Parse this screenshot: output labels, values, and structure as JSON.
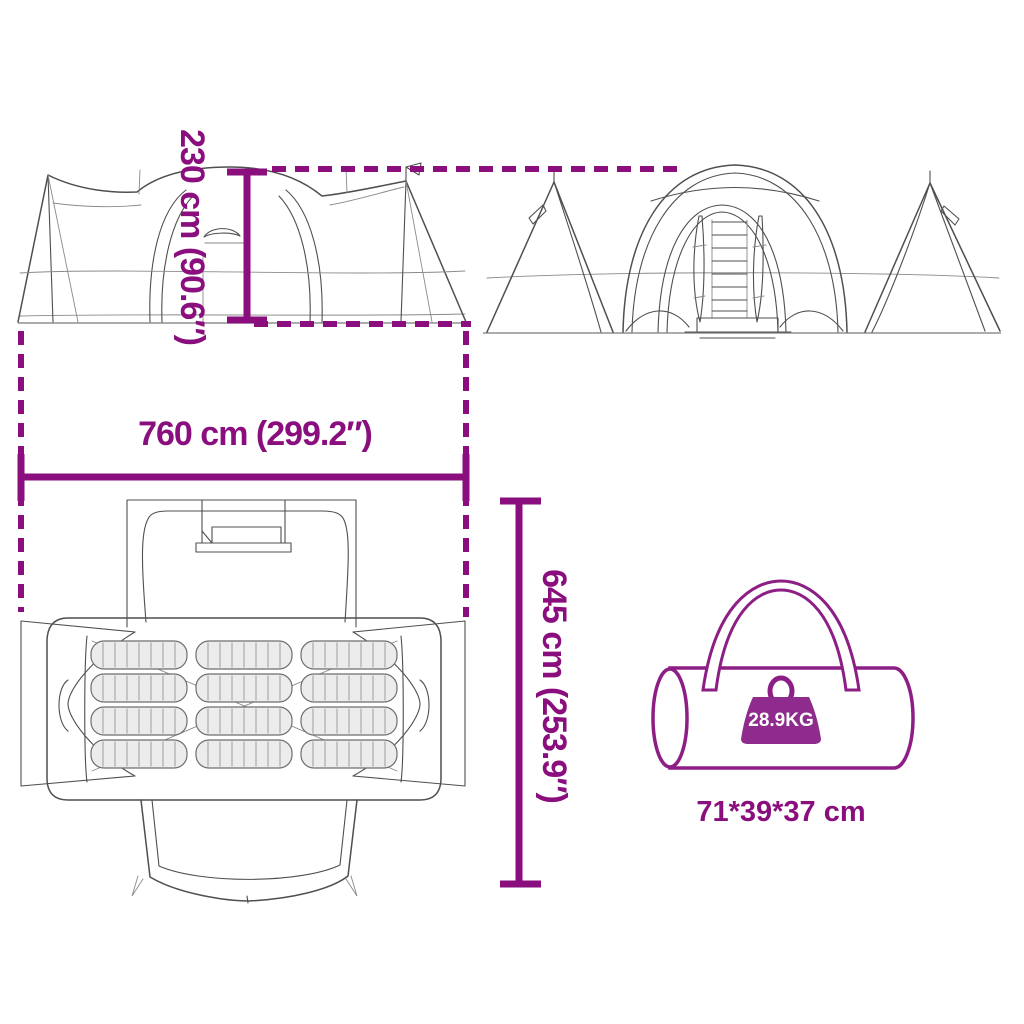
{
  "title": "Tent dimensions product diagram",
  "colors": {
    "accent": "#8A0E7D",
    "badge": "#8E2B8C",
    "bag_outline": "#8C1E85",
    "line_art": "#4F4F4F",
    "mat_fill": "#ECECEC",
    "background": "#FFFFFF"
  },
  "labels": {
    "tent_height": "230 cm (90.6″)",
    "tent_length": "760 cm (299.2″)",
    "tent_width": "645 cm (253.9″)"
  },
  "bag": {
    "weight": "28.9KG",
    "size": "71*39*37 cm"
  },
  "top_view": {
    "sleeping_pad_columns": 3,
    "sleeping_pad_rows": 4
  }
}
